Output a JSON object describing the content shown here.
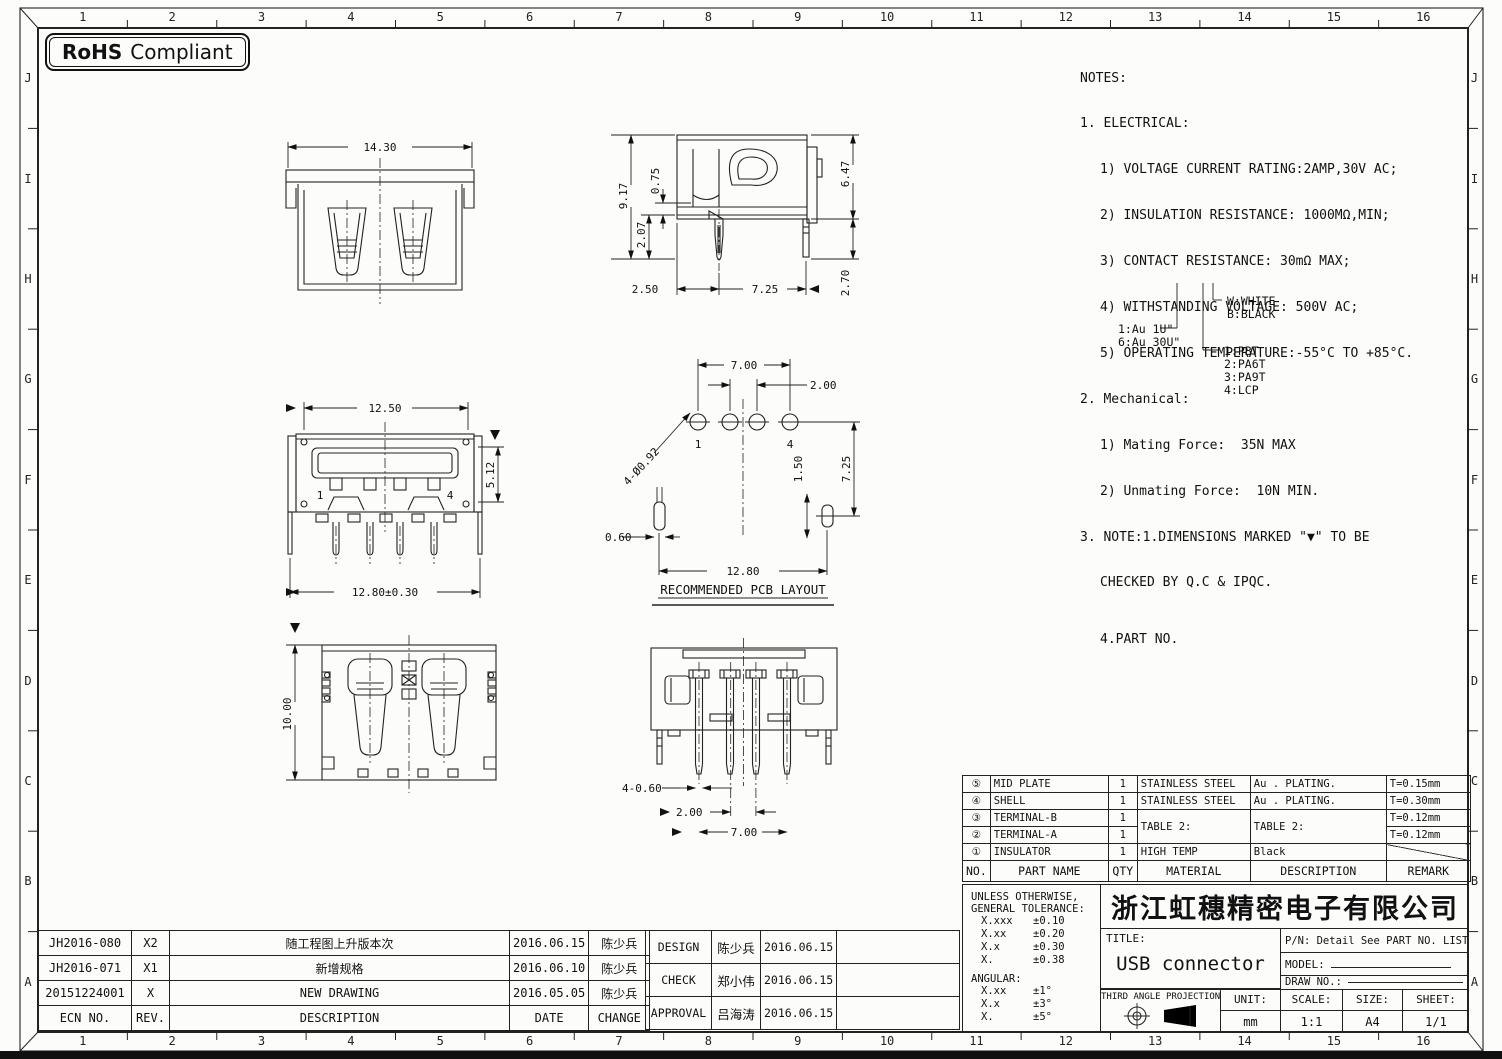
{
  "sheet": {
    "grid": {
      "columns": [
        "1",
        "2",
        "3",
        "4",
        "5",
        "6",
        "7",
        "8",
        "9",
        "10",
        "11",
        "12",
        "13",
        "14",
        "15",
        "16"
      ],
      "rows": [
        "J",
        "I",
        "H",
        "G",
        "F",
        "E",
        "D",
        "C",
        "B",
        "A"
      ]
    },
    "badge": {
      "bold": "RoHS",
      "rest": "Compliant"
    }
  },
  "notes": {
    "title": "NOTES:",
    "electrical_header": "1. ELECTRICAL:",
    "electrical": [
      "1) VOLTAGE CURRENT RATING:2AMP,30V AC;",
      "2) INSULATION RESISTANCE: 1000MΩ,MIN;",
      "3) CONTACT RESISTANCE: 30mΩ MAX;",
      "4) WITHSTANDING VOLTAGE: 500V AC;",
      "5) OPERATING TEMPERATURE:-55°C TO +85°C."
    ],
    "mechanical_header": "2. Mechanical:",
    "mechanical": [
      "1) Mating Force:  35N MAX",
      "2) Unmating Force:  10N MIN."
    ],
    "note3_line1": "3. NOTE:1.DIMENSIONS MARKED \"▼\" TO BE",
    "note3_line2": "CHECKED BY Q.C & IPQC.",
    "note4": "4.PART NO."
  },
  "legend": {
    "plating1": "1:Au 1U\"",
    "plating2": "6:Au 30U\"",
    "color1": "W:WHITE",
    "color2": "B:BLACK",
    "mat1": "1:PBT",
    "mat2": "2:PA6T",
    "mat3": "3:PA9T",
    "mat4": "4:LCP"
  },
  "views": {
    "rear": {
      "w": "14.30"
    },
    "side": {
      "h": "9.17",
      "a": "2.07",
      "b": "0.75",
      "c": "6.47",
      "d": "2.70",
      "e": "2.50",
      "f": "7.25"
    },
    "front": {
      "top": "12.50",
      "right": "5.12",
      "bottom": "12.80±0.30",
      "p1": "1",
      "p4": "4"
    },
    "pcb": {
      "a": "7.00",
      "b": "2.00",
      "holes": "4-Ø0.92",
      "c": "1.50",
      "d": "7.25",
      "e": "0.60",
      "f": "12.80",
      "p1": "1",
      "p4": "4",
      "title": "RECOMMENDED PCB LAYOUT"
    },
    "top": {
      "h": "10.00"
    },
    "bottom": {
      "a": "4-0.60",
      "b": "2.00",
      "c": "7.00"
    }
  },
  "parts_table": {
    "headers": {
      "no": "NO.",
      "part_name": "PART NAME",
      "qty": "QTY",
      "material": "MATERIAL",
      "description": "DESCRIPTION",
      "remark": "REMARK"
    },
    "rows": [
      {
        "no": "⑤",
        "part_name": "MID PLATE",
        "qty": "1",
        "material": "STAINLESS STEEL",
        "description": "Au . PLATING.",
        "remark": "T=0.15mm"
      },
      {
        "no": "④",
        "part_name": "SHELL",
        "qty": "1",
        "material": "STAINLESS STEEL",
        "description": "Au . PLATING.",
        "remark": "T=0.30mm"
      },
      {
        "no": "③",
        "part_name": "TERMINAL-B",
        "qty": "1",
        "material": "TABLE 2:",
        "description": "TABLE 2:",
        "remark": "T=0.12mm"
      },
      {
        "no": "②",
        "part_name": "TERMINAL-A",
        "qty": "1",
        "material": "",
        "description": "",
        "remark": "T=0.12mm"
      },
      {
        "no": "①",
        "part_name": "INSULATOR",
        "qty": "1",
        "material": "HIGH TEMP",
        "description": "Black",
        "remark": ""
      }
    ]
  },
  "title_block": {
    "tolerance": {
      "header1": "UNLESS OTHERWISE,",
      "header2": "GENERAL TOLERANCE:",
      "linear": [
        {
          "k": "X.xxx",
          "v": "±0.10"
        },
        {
          "k": "X.xx",
          "v": "±0.20"
        },
        {
          "k": "X.x",
          "v": "±0.30"
        },
        {
          "k": "X.",
          "v": "±0.38"
        }
      ],
      "angular_header": "ANGULAR:",
      "angular": [
        {
          "k": "X.xx",
          "v": "±1°"
        },
        {
          "k": "X.x",
          "v": "±3°"
        },
        {
          "k": "X.",
          "v": "±5°"
        }
      ]
    },
    "company": "浙江虹穗精密电子有限公司",
    "title_label": "TITLE:",
    "title_value": "USB connector",
    "pn": "P/N: Detail See PART NO. LIST",
    "model_label": "MODEL:",
    "draw_no_label": "DRAW NO.:",
    "projection": "THIRD ANGLE PROJECTION",
    "unit_label": "UNIT:",
    "unit_value": "mm",
    "scale_label": "SCALE:",
    "scale_value": "1:1",
    "size_label": "SIZE:",
    "size_value": "A4",
    "sheet_label": "SHEET:",
    "sheet_value": "1/1"
  },
  "revision_table": {
    "headers": {
      "ecn": "ECN NO.",
      "rev": "REV.",
      "description": "DESCRIPTION",
      "date": "DATE",
      "change": "CHANGE"
    },
    "rows": [
      {
        "ecn": "JH2016-080",
        "rev": "X2",
        "description": "随工程图上升版本次",
        "date": "2016.06.15",
        "change": "陈少兵"
      },
      {
        "ecn": "JH2016-071",
        "rev": "X1",
        "description": "新增规格",
        "date": "2016.06.10",
        "change": "陈少兵"
      },
      {
        "ecn": "20151224001",
        "rev": "X",
        "description": "NEW DRAWING",
        "date": "2016.05.05",
        "change": "陈少兵"
      }
    ]
  },
  "approval_table": {
    "rows": [
      {
        "role": "DESIGN",
        "name": "陈少兵",
        "date": "2016.06.15"
      },
      {
        "role": "CHECK",
        "name": "郑小伟",
        "date": "2016.06.15"
      },
      {
        "role": "APPROVAL",
        "name": "吕海涛",
        "date": "2016.06.15"
      }
    ]
  }
}
